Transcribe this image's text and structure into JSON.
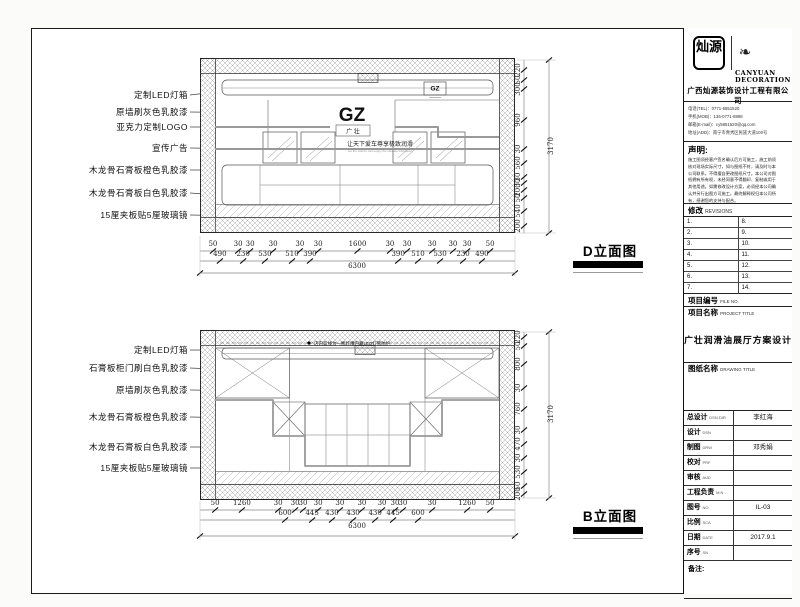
{
  "sheet": {
    "brand_cn": "灿源",
    "brand_en_line1": "CANYUAN",
    "brand_en_line2": "DECORATION",
    "company_cn": "广西灿源装饰设计工程有限公司",
    "contact_lines": [
      "电话(TEL)：0771-5851520",
      "手机(MOB)：136-0771-8898",
      "邮箱(E-mail)：cy5851520@qq.com",
      "地址(ADD)：南宁市青秀区民族大道100号"
    ],
    "statement_title": "声明:",
    "statement_lines": [
      "施工图须经客户签名确认后方可施工，施工前须",
      "核对现场实际尺寸，如与图纸不符，请及时与本",
      "公司联系，不得擅自更改图纸尺寸。本公司对图",
      "纸拥有所有权，未经同意不得翻印、复制或用于",
      "其他用途。如需修改设计方案，必须经本公司确",
      "认并另行出图方可施工。最终解释权归本公司所",
      "有，感谢您的支持与配合。"
    ],
    "revisions_label_cn": "修改",
    "revisions_label_en": "REVISIONS",
    "revision_numbers_left": [
      "1.",
      "2.",
      "3.",
      "4.",
      "5.",
      "6.",
      "7."
    ],
    "revision_numbers_right": [
      "8.",
      "9.",
      "10.",
      "11.",
      "12.",
      "13.",
      "14."
    ],
    "file_no_label": "项目编号",
    "file_no_en": "FILE NO.",
    "project_title_label": "项目名称",
    "project_title_en": "PROJECT TITLE",
    "project_title": "广壮润滑油展厅方案设计",
    "drawing_title_label": "图纸名称",
    "drawing_title_en": "DRAWING TITLE",
    "rows": [
      {
        "label": "总设计",
        "en": "DSN.DIR",
        "value": "李红海"
      },
      {
        "label": "设计",
        "en": "DSN",
        "value": ""
      },
      {
        "label": "制图",
        "en": "DRW",
        "value": "邓秀娟"
      },
      {
        "label": "校对",
        "en": "PRF",
        "value": ""
      },
      {
        "label": "审核",
        "en": "AUD",
        "value": ""
      },
      {
        "label": "工程负责",
        "en": "M.N",
        "value": ""
      },
      {
        "label": "图号",
        "en": "NO.",
        "value": "IL-03"
      },
      {
        "label": "比例",
        "en": "SCA",
        "value": ""
      },
      {
        "label": "日期",
        "en": "DATE",
        "value": "2017.9.1"
      },
      {
        "label": "序号",
        "en": "SN",
        "value": ""
      }
    ],
    "remark_label": "备注:"
  },
  "d_elevation": {
    "name": "D立面图",
    "logo_main": "GZ",
    "logo_sub": "广 壮",
    "logo_small": "GZ",
    "slogan": "让天下爱车尊享极致润滑",
    "slogan_en": "Let the world's cars enjoy the ultimate lubrication",
    "labels": [
      "定制LED灯箱",
      "原墙刷灰色乳胶漆",
      "亚克力定制LOGO",
      "宣传广告",
      "木龙骨石膏板橙色乳胶漆",
      "木龙骨石膏板白色乳胶漆",
      "15厘夹板贴5厘玻璃镜"
    ],
    "dims_row1": [
      "50",
      "30",
      "30",
      "30",
      "30",
      "30",
      "1600",
      "30",
      "30",
      "30",
      "30",
      "30",
      "50"
    ],
    "dims_row2": [
      "490",
      "230",
      "530",
      "510",
      "390",
      "390",
      "510",
      "530",
      "230",
      "490"
    ],
    "dims_total": "6300",
    "vdims": [
      "220",
      "50",
      "300",
      "960",
      "30",
      "560",
      "30",
      "30",
      "200",
      "50",
      "540",
      "200"
    ],
    "vdim_total": "3170"
  },
  "b_elevation": {
    "name": "B立面图",
    "note": "店内蓝线为一圈灯槽内藏LED灯管防护",
    "labels": [
      "定制LED灯箱",
      "石膏板柜门刷白色乳胶漆",
      "原墙刷灰色乳胶漆",
      "木龙骨石膏板橙色乳胶漆",
      "木龙骨石膏板白色乳胶漆",
      "15厘夹板贴5厘玻璃镜"
    ],
    "dims_row1": [
      "50",
      "1260",
      "30",
      "30",
      "30",
      "30",
      "30",
      "30",
      "30",
      "30",
      "30",
      "30",
      "1260",
      "50"
    ],
    "dims_row2": [
      "600",
      "445",
      "430",
      "430",
      "430",
      "445",
      "600"
    ],
    "dims_total": "6300",
    "vdims": [
      "220",
      "50",
      "800",
      "30",
      "760",
      "30",
      "470",
      "30",
      "530",
      "50",
      "200"
    ],
    "vdim_total": "3170"
  }
}
